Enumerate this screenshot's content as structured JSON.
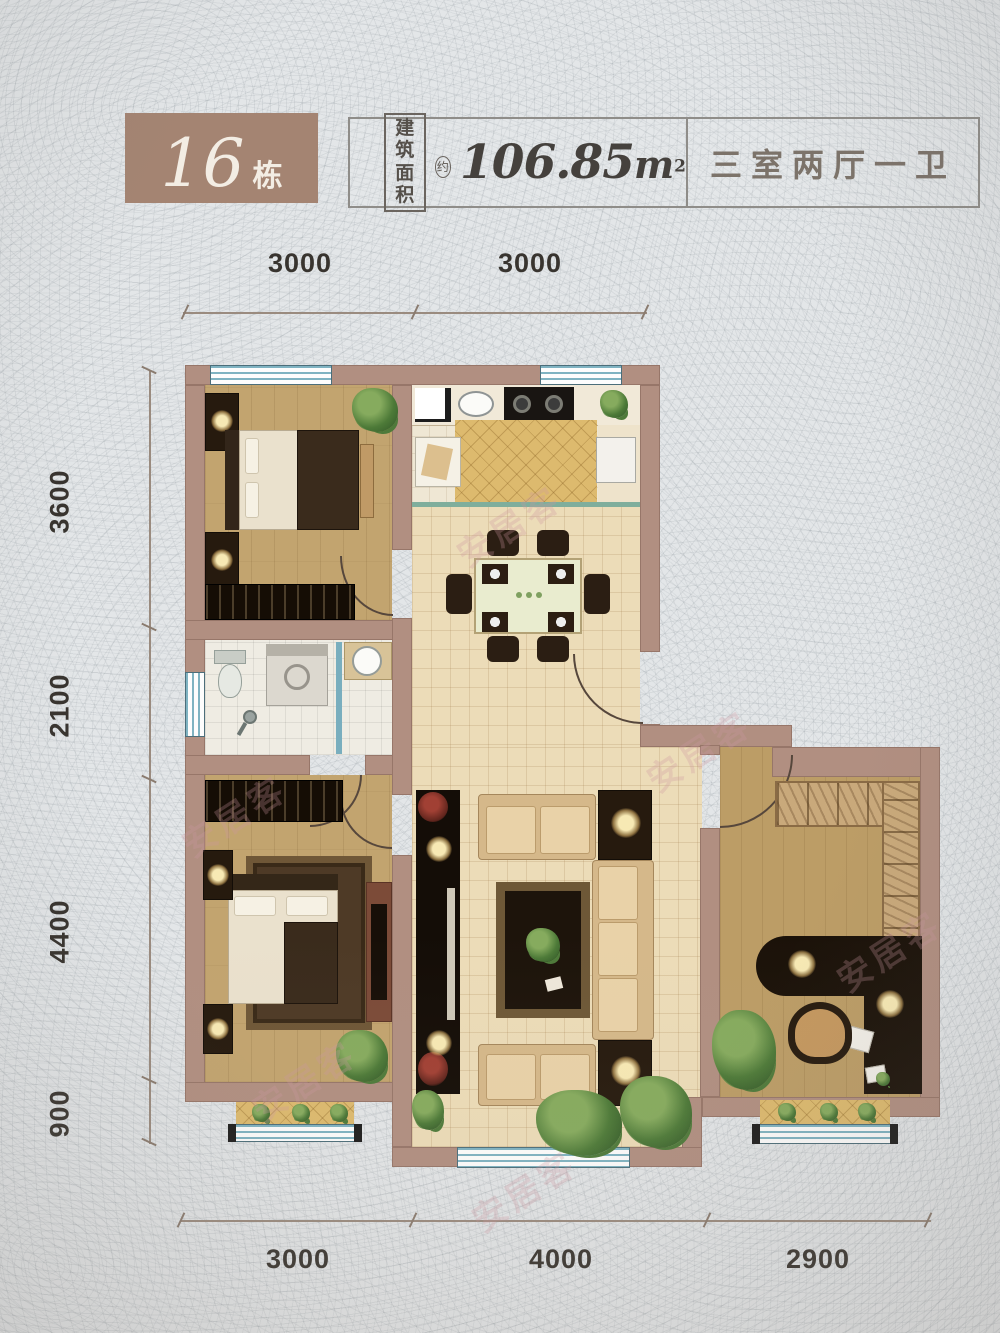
{
  "header": {
    "building": {
      "number": "16",
      "unit": "栋"
    },
    "area": {
      "label_line1": "建筑",
      "label_line2": "面积",
      "approx": "约",
      "value": "106.85",
      "unit": "m",
      "superscript": "2"
    },
    "layout": "三室两厅一卫"
  },
  "dimensions": {
    "top": [
      "3000",
      "3000"
    ],
    "left": [
      "3600",
      "2100",
      "4400",
      "900"
    ],
    "bottom": [
      "3000",
      "4000",
      "2900"
    ]
  },
  "watermark": "安居客",
  "colors": {
    "background": "#e3e6e8",
    "wall": "#b18f81",
    "header_box": "#a48472",
    "window": "#7fb3c2",
    "wood_floor": "#c2a46f",
    "tile_floor": "#ecdcb8",
    "bay_gold": "#ddba6e",
    "dimension_text": "#38342f"
  }
}
